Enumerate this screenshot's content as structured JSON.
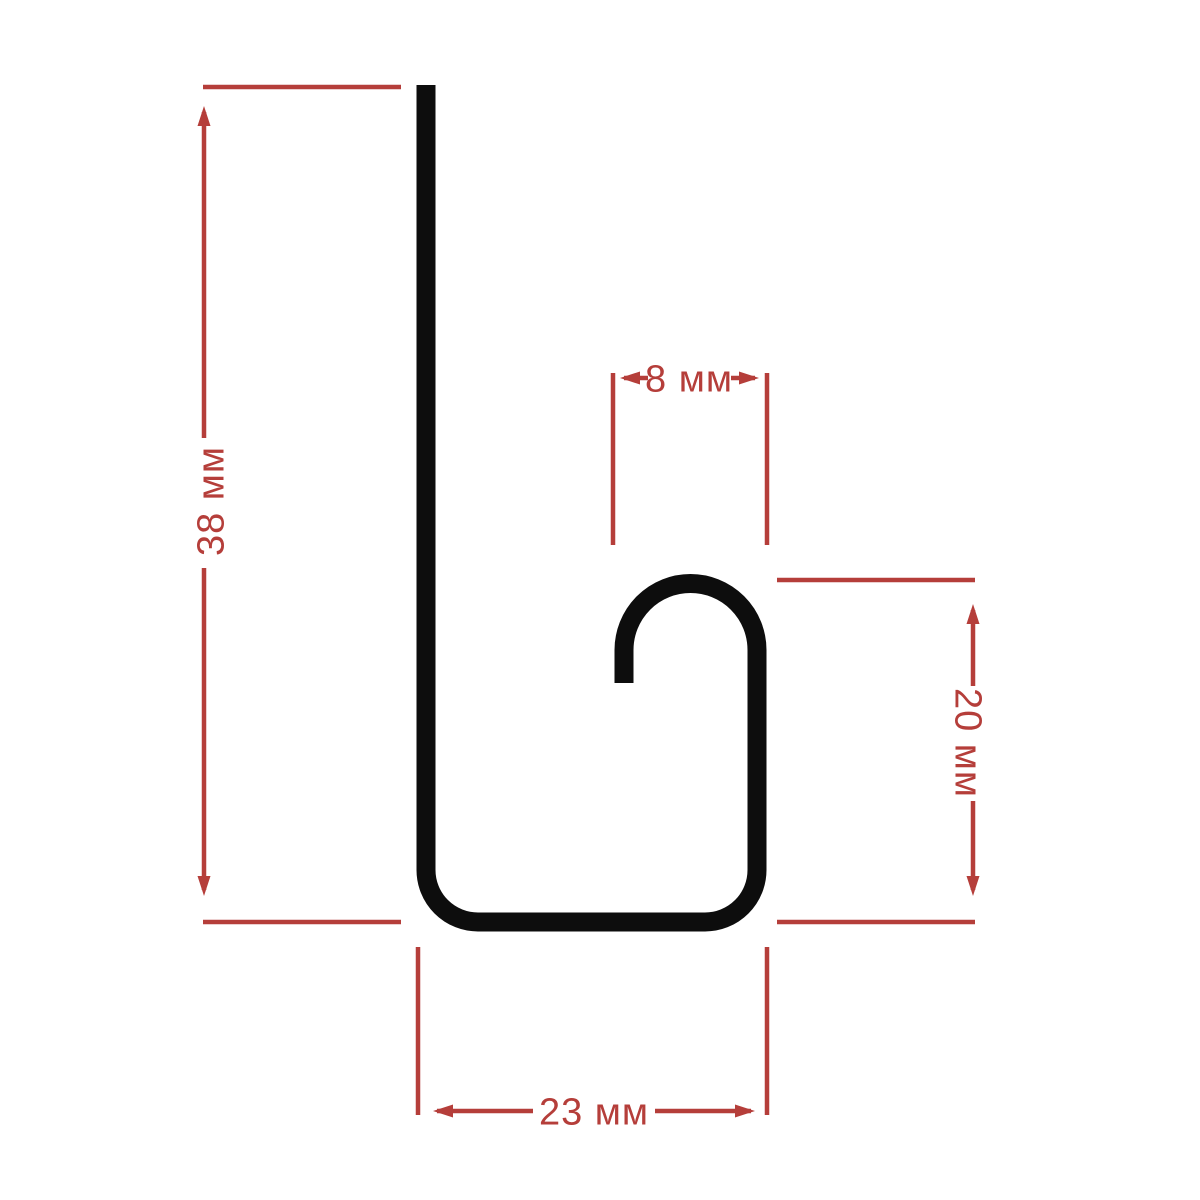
{
  "drawing": {
    "kind": "profile-cross-section-dimension-drawing"
  },
  "colors": {
    "profile": "#0d0d0d",
    "dimension": "#b53e3a",
    "background": "#ffffff"
  },
  "dimensions": {
    "height": {
      "label": "38 мм",
      "value": "38",
      "unit": "мм"
    },
    "hook_width": {
      "label": "8 мм",
      "value": "8",
      "unit": "мм"
    },
    "hook_height": {
      "label": "20 мм",
      "value": "20",
      "unit": "мм"
    },
    "base_width": {
      "label": "23 мм",
      "value": "23",
      "unit": "мм"
    }
  }
}
